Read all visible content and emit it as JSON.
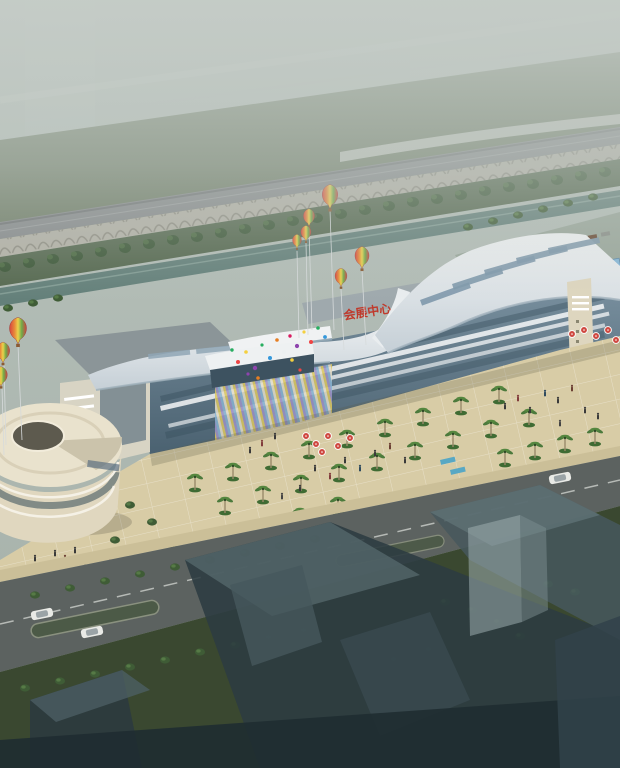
{
  "scene": {
    "description": "Aerial architectural rendering of a convention-exhibition center with wavy white roofs, festival hot-air balloons, a palm-lined plaza with crowds, an elevated arched viaduct and canal behind, and translucent future-phase building masses in the foreground",
    "building_sign": "会展中心",
    "counts": {
      "hot_air_balloons": "9",
      "confetti_balloons": "18"
    },
    "colors": {
      "haze_top": "#bac3bd",
      "haze_bottom": "#a3afa7",
      "field_green": "#6d7b64",
      "viaduct_grey": "#85888a",
      "arcade_cream": "#b3b1a6",
      "embankment_green": "#55684f",
      "tree_green": "#3c5737",
      "canal_teal": "#64807a",
      "roof_white": "#f2f4f5",
      "roof_shade": "#c5cfd6",
      "glass_light": "#8299a8",
      "glass_dark": "#4a6170",
      "sign_red": "#c0392b",
      "stripe_yellow": "#dcc75f",
      "stripe_purple": "#9d92c6",
      "stripe_blue": "#88b3d2",
      "stripe_cream": "#e4ddc9",
      "drum_cream": "#e9e2cd",
      "pylon_beige": "#ded6bf",
      "plaza_tan": "#d8cca6",
      "sidewalk_tan": "#cbbf98",
      "road_grey": "#5c6260",
      "median_green": "#4c5a47",
      "lawn_dark": "#3a4830",
      "ghost_dark": "#2c3b41",
      "ghost_mid": "#46585d",
      "ghost_light": "#9cadaf",
      "balloon_red": "#d8433f",
      "balloon_orange": "#e88a3a",
      "balloon_yellow": "#ead24b",
      "balloon_green": "#6fa94a",
      "umbrella_red": "#cf4840",
      "water_blue": "#58a8c4",
      "canopy_blue": "#86b7d8"
    }
  }
}
